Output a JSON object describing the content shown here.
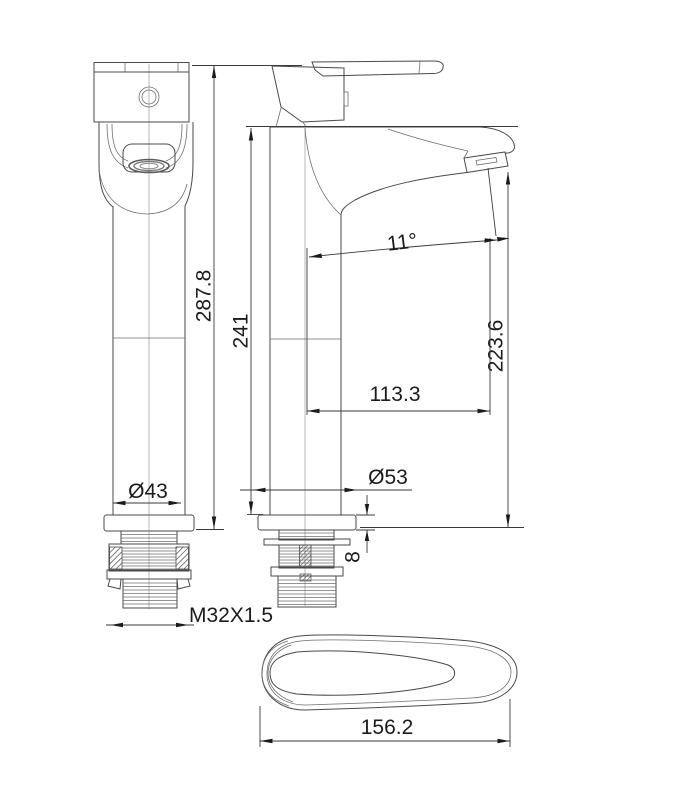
{
  "drawing": {
    "type": "technical-drawing-faucet",
    "views": {
      "front_view": "tall basin mixer, front elevation",
      "side_view": "tall basin mixer, side elevation",
      "top_view": "lever handle, top view"
    },
    "dimensions": {
      "total_height": "287.8",
      "body_height": "241",
      "outlet_height": "223.6",
      "spout_reach": "113.3",
      "spout_angle": "11°",
      "front_base_diameter": "Ø43",
      "side_base_diameter": "Ø53",
      "base_plate_thickness": "8",
      "thread_spec": "M32X1.5",
      "handle_length": "156.2"
    },
    "colors": {
      "background": "#ffffff",
      "line": "#4a4a4a",
      "dimension_line": "#3a3a3a",
      "text": "#1b1b1b"
    }
  }
}
